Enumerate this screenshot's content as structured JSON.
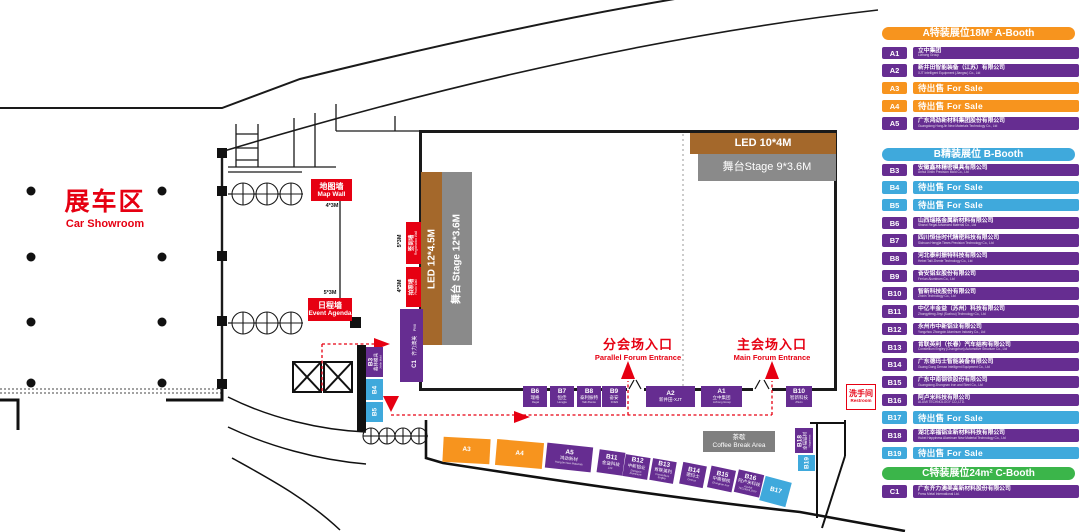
{
  "colors": {
    "purple": "#662D91",
    "orange": "#F7941E",
    "cyan": "#3FA9DC",
    "green": "#3BB54A",
    "red": "#E60012",
    "brown": "#A4682B",
    "stage_gray": "#8A8A8A",
    "coffee_gray": "#7F7F7F"
  },
  "showroom": {
    "zh": "展车区",
    "en": "Car Showroom"
  },
  "walls": {
    "map_wall": {
      "zh": "地图墙",
      "en": "Map Wall",
      "size": "4*3M"
    },
    "event_agenda": {
      "zh": "日程墙",
      "en": "Event Agenda",
      "size": "5*3M"
    },
    "registration_wall": {
      "zh": "签到墙",
      "en": "Registration Wall",
      "size": "5*3M"
    },
    "photo_wall": {
      "zh": "拍照墙",
      "en": "Photo Wall",
      "size": "4*3M"
    }
  },
  "stages": {
    "led_top": "LED 10*4M",
    "stage_top": "舞台Stage 9*3.6M",
    "led_left": "LED 12*4.5M",
    "stage_left": "舞台 Stage 12*3.6M"
  },
  "entrances": {
    "parallel": {
      "zh": "分会场入口",
      "en": "Parallel Forum Entrance"
    },
    "main": {
      "zh": "主会场入口",
      "en": "Main Forum Entrance"
    }
  },
  "areas": {
    "coffee": {
      "zh": "茶歇",
      "en": "Coffee Break Area"
    },
    "restroom": {
      "zh": "洗手间",
      "en": "Restroom"
    },
    "c1_booth": {
      "id": "C1",
      "zh": "齐力澳美",
      "en": "PMI"
    }
  },
  "map_booths": {
    "bottom_row": [
      {
        "id": "B6",
        "zh": "瑞格",
        "en": "Regal"
      },
      {
        "id": "B7",
        "zh": "恒佳",
        "en": "Hengjia"
      },
      {
        "id": "B8",
        "zh": "泰利振特",
        "en": "Taili Zhente"
      },
      {
        "id": "B9",
        "zh": "奋安",
        "en": "FOEN"
      },
      {
        "id": "A2",
        "zh": "新井田-XJT",
        "en": ""
      },
      {
        "id": "A1",
        "zh": "立中集团",
        "en": "Lizhong Group"
      },
      {
        "id": "B10",
        "zh": "智新科技",
        "en": "Zhixin"
      }
    ],
    "diagonal": [
      {
        "id": "A3",
        "zh": "",
        "en": ""
      },
      {
        "id": "A4",
        "zh": "",
        "en": ""
      },
      {
        "id": "A5",
        "zh": "鸿劲新材",
        "en": "HongJin New Materials"
      },
      {
        "id": "B11",
        "zh": "金益科技",
        "en": "ZJF"
      },
      {
        "id": "B12",
        "zh": "中新铝业",
        "en": "Zhongxin Aluminum"
      },
      {
        "id": "B13",
        "zh": "肯联英利",
        "en": "Constellium Engley"
      },
      {
        "id": "B14",
        "zh": "德玛士",
        "en": "Demax"
      },
      {
        "id": "B15",
        "zh": "中南钢铁",
        "en": "Zhongnan Iron"
      },
      {
        "id": "B16",
        "zh": "阿卢米科技",
        "en": "ALUMI TECHNOLOGY"
      },
      {
        "id": "B17",
        "zh": "",
        "en": ""
      }
    ],
    "side": [
      {
        "id": "B3",
        "zh": "鑫林模具",
        "en": "Xinlin Mold"
      },
      {
        "id": "B4",
        "zh": "",
        "en": ""
      },
      {
        "id": "B5",
        "zh": "",
        "en": ""
      },
      {
        "id": "B18",
        "zh": "幸福铝材",
        "en": "Happiness"
      },
      {
        "id": "B19",
        "zh": "",
        "en": ""
      }
    ]
  },
  "legend": {
    "sections": [
      {
        "id": "A",
        "title": "A特装展位18M² A-Booth",
        "accent": "#F7941E",
        "forsale_accent": "#F7941E",
        "rows": [
          {
            "id": "A1",
            "type": "sold",
            "zh": "立中集团",
            "en": "Lizhong Group"
          },
          {
            "id": "A2",
            "type": "sold",
            "zh": "新井田智能装备（江苏）有限公司",
            "en": "XJT Intelligent Equipment (Jiangsu) Co., Ltd"
          },
          {
            "id": "A3",
            "type": "forsale",
            "label": "待出售 For Sale"
          },
          {
            "id": "A4",
            "type": "forsale",
            "label": "待出售 For Sale"
          },
          {
            "id": "A5",
            "type": "sold",
            "zh": "广东鸿劲新材料集团股份有限公司",
            "en": "Guangdong HongJin New Materials Technology Co., Ltd"
          }
        ]
      },
      {
        "id": "B",
        "title": "B精装展位  B-Booth",
        "accent": "#3FA9DC",
        "forsale_accent": "#3FA9DC",
        "rows": [
          {
            "id": "B3",
            "type": "sold",
            "zh": "安徽鑫林精密模具有限公司",
            "en": "Anhui Xinlin Precision Mold Co., Ltd"
          },
          {
            "id": "B4",
            "type": "forsale",
            "label": "待出售 For Sale"
          },
          {
            "id": "B5",
            "type": "forsale",
            "label": "待出售 For Sale"
          },
          {
            "id": "B6",
            "type": "sold",
            "zh": "山西瑞格金属新材料有限公司",
            "en": "Shanxi Regal Advanced Material Co., Ltd"
          },
          {
            "id": "B7",
            "type": "sold",
            "zh": "四川恒佳时代精密科技有限公司",
            "en": "Sichuan Hengjia Times Precision Technology Co., Ltd"
          },
          {
            "id": "B8",
            "type": "sold",
            "zh": "河北泰利振特科技有限公司",
            "en": "Hebei Taili Zhente Technology Co., Ltd"
          },
          {
            "id": "B9",
            "type": "sold",
            "zh": "奋安铝业股份有限公司",
            "en": "Fen'an Aluminum Co., Ltd"
          },
          {
            "id": "B10",
            "type": "sold",
            "zh": "智新科技股份有限公司",
            "en": "Zhixin Technology Co., Ltd"
          },
          {
            "id": "B11",
            "type": "sold",
            "zh": "中亿丰金益（苏州）科技有限公司",
            "en": "Zhongyifeng Jinyi (Suzhou) Technology Co., Ltd"
          },
          {
            "id": "B12",
            "type": "sold",
            "zh": "永州市中新铝业有限公司",
            "en": "Yongzhou Zhongxin Aluminum Industry Co., Ltd"
          },
          {
            "id": "B13",
            "type": "sold",
            "zh": "肯联英利（长春）汽车结构有限公司",
            "en": "Constellium Engley (Changchun) Automotive Structure Co., Ltd"
          },
          {
            "id": "B14",
            "type": "sold",
            "zh": "广东德玛士智能装备有限公司",
            "en": "Guang Dong Demax Intelligent Equipment Co., Ltd"
          },
          {
            "id": "B15",
            "type": "sold",
            "zh": "广东中南钢铁股份有限公司",
            "en": "Guangdong Zhongnan Iron and Steel Co., Ltd"
          },
          {
            "id": "B16",
            "type": "sold",
            "zh": "阿卢米科技有限公司",
            "en": "ALUMI TECHNOLOGY CO.,LTD."
          },
          {
            "id": "B17",
            "type": "forsale",
            "label": "待出售 For Sale"
          },
          {
            "id": "B18",
            "type": "sold",
            "zh": "湖北幸福铝业新材料科技有限公司",
            "en": "Hubei Happiness Aluminum New Material Technology Co., Ltd"
          },
          {
            "id": "B19",
            "type": "forsale",
            "label": "待出售 For Sale"
          }
        ]
      },
      {
        "id": "C",
        "title": "C特装展位24m²  C-Booth",
        "accent": "#3BB54A",
        "forsale_accent": "#3BB54A",
        "rows": [
          {
            "id": "C1",
            "type": "sold",
            "zh": "广东齐力澳美高新材料股份有限公司",
            "en": "Press Metal International Ltd."
          }
        ]
      }
    ]
  }
}
